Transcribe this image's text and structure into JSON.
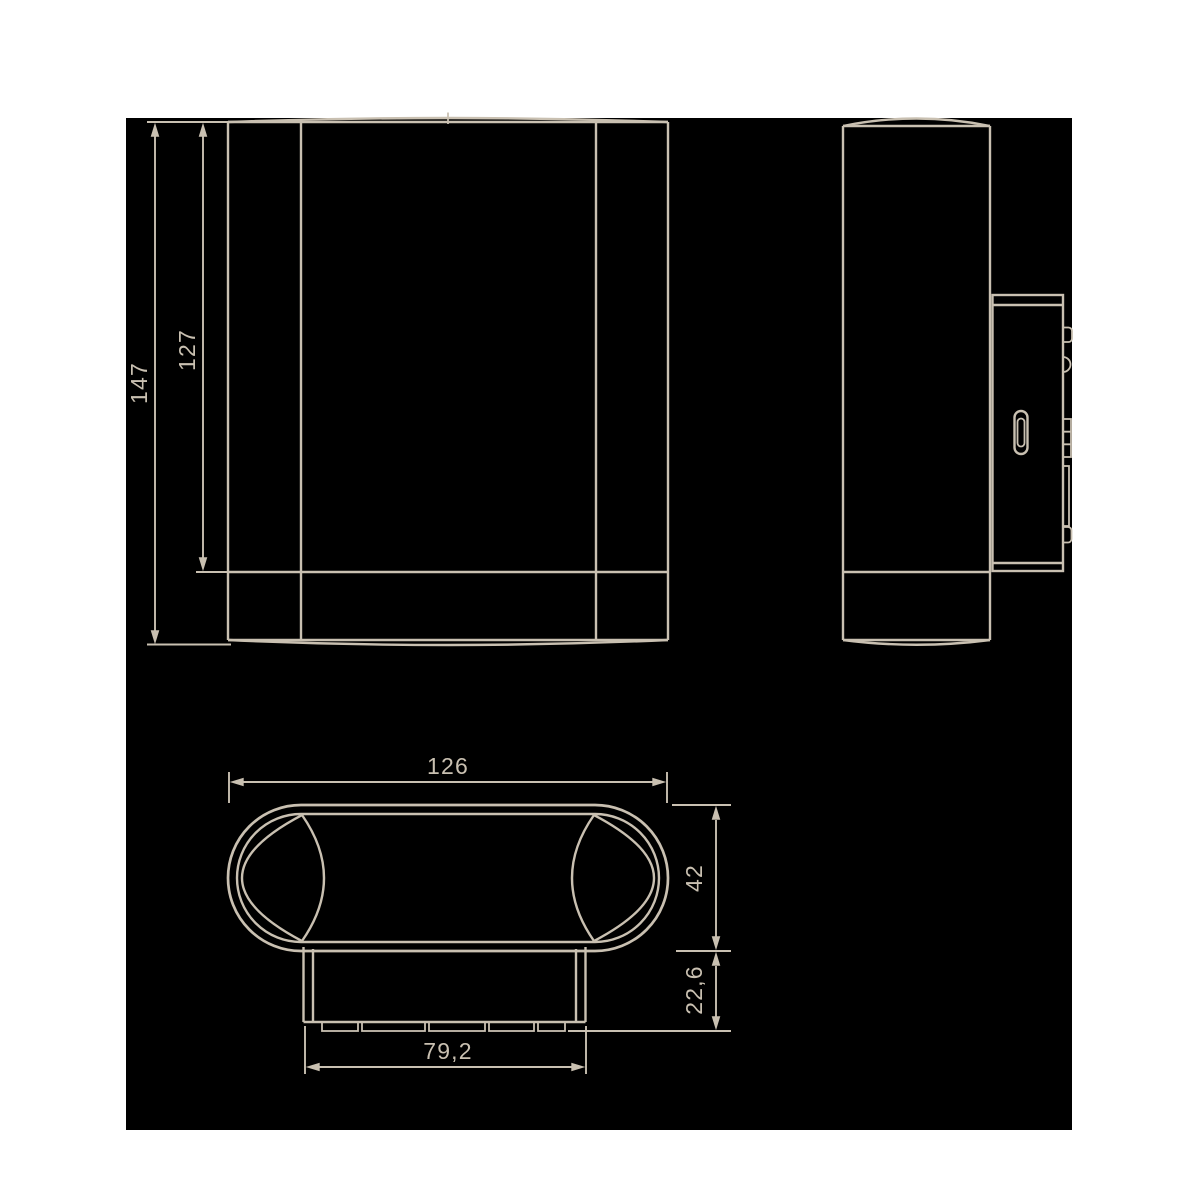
{
  "colors": {
    "page_background": "#ffffff",
    "canvas": "#000000",
    "line": "#c9c0b1"
  },
  "dimensions": {
    "total_height": "147",
    "body_height": "127",
    "total_width": "126",
    "body_diameter": "42",
    "mount_depth": "22,6",
    "mount_width": "79,2"
  }
}
